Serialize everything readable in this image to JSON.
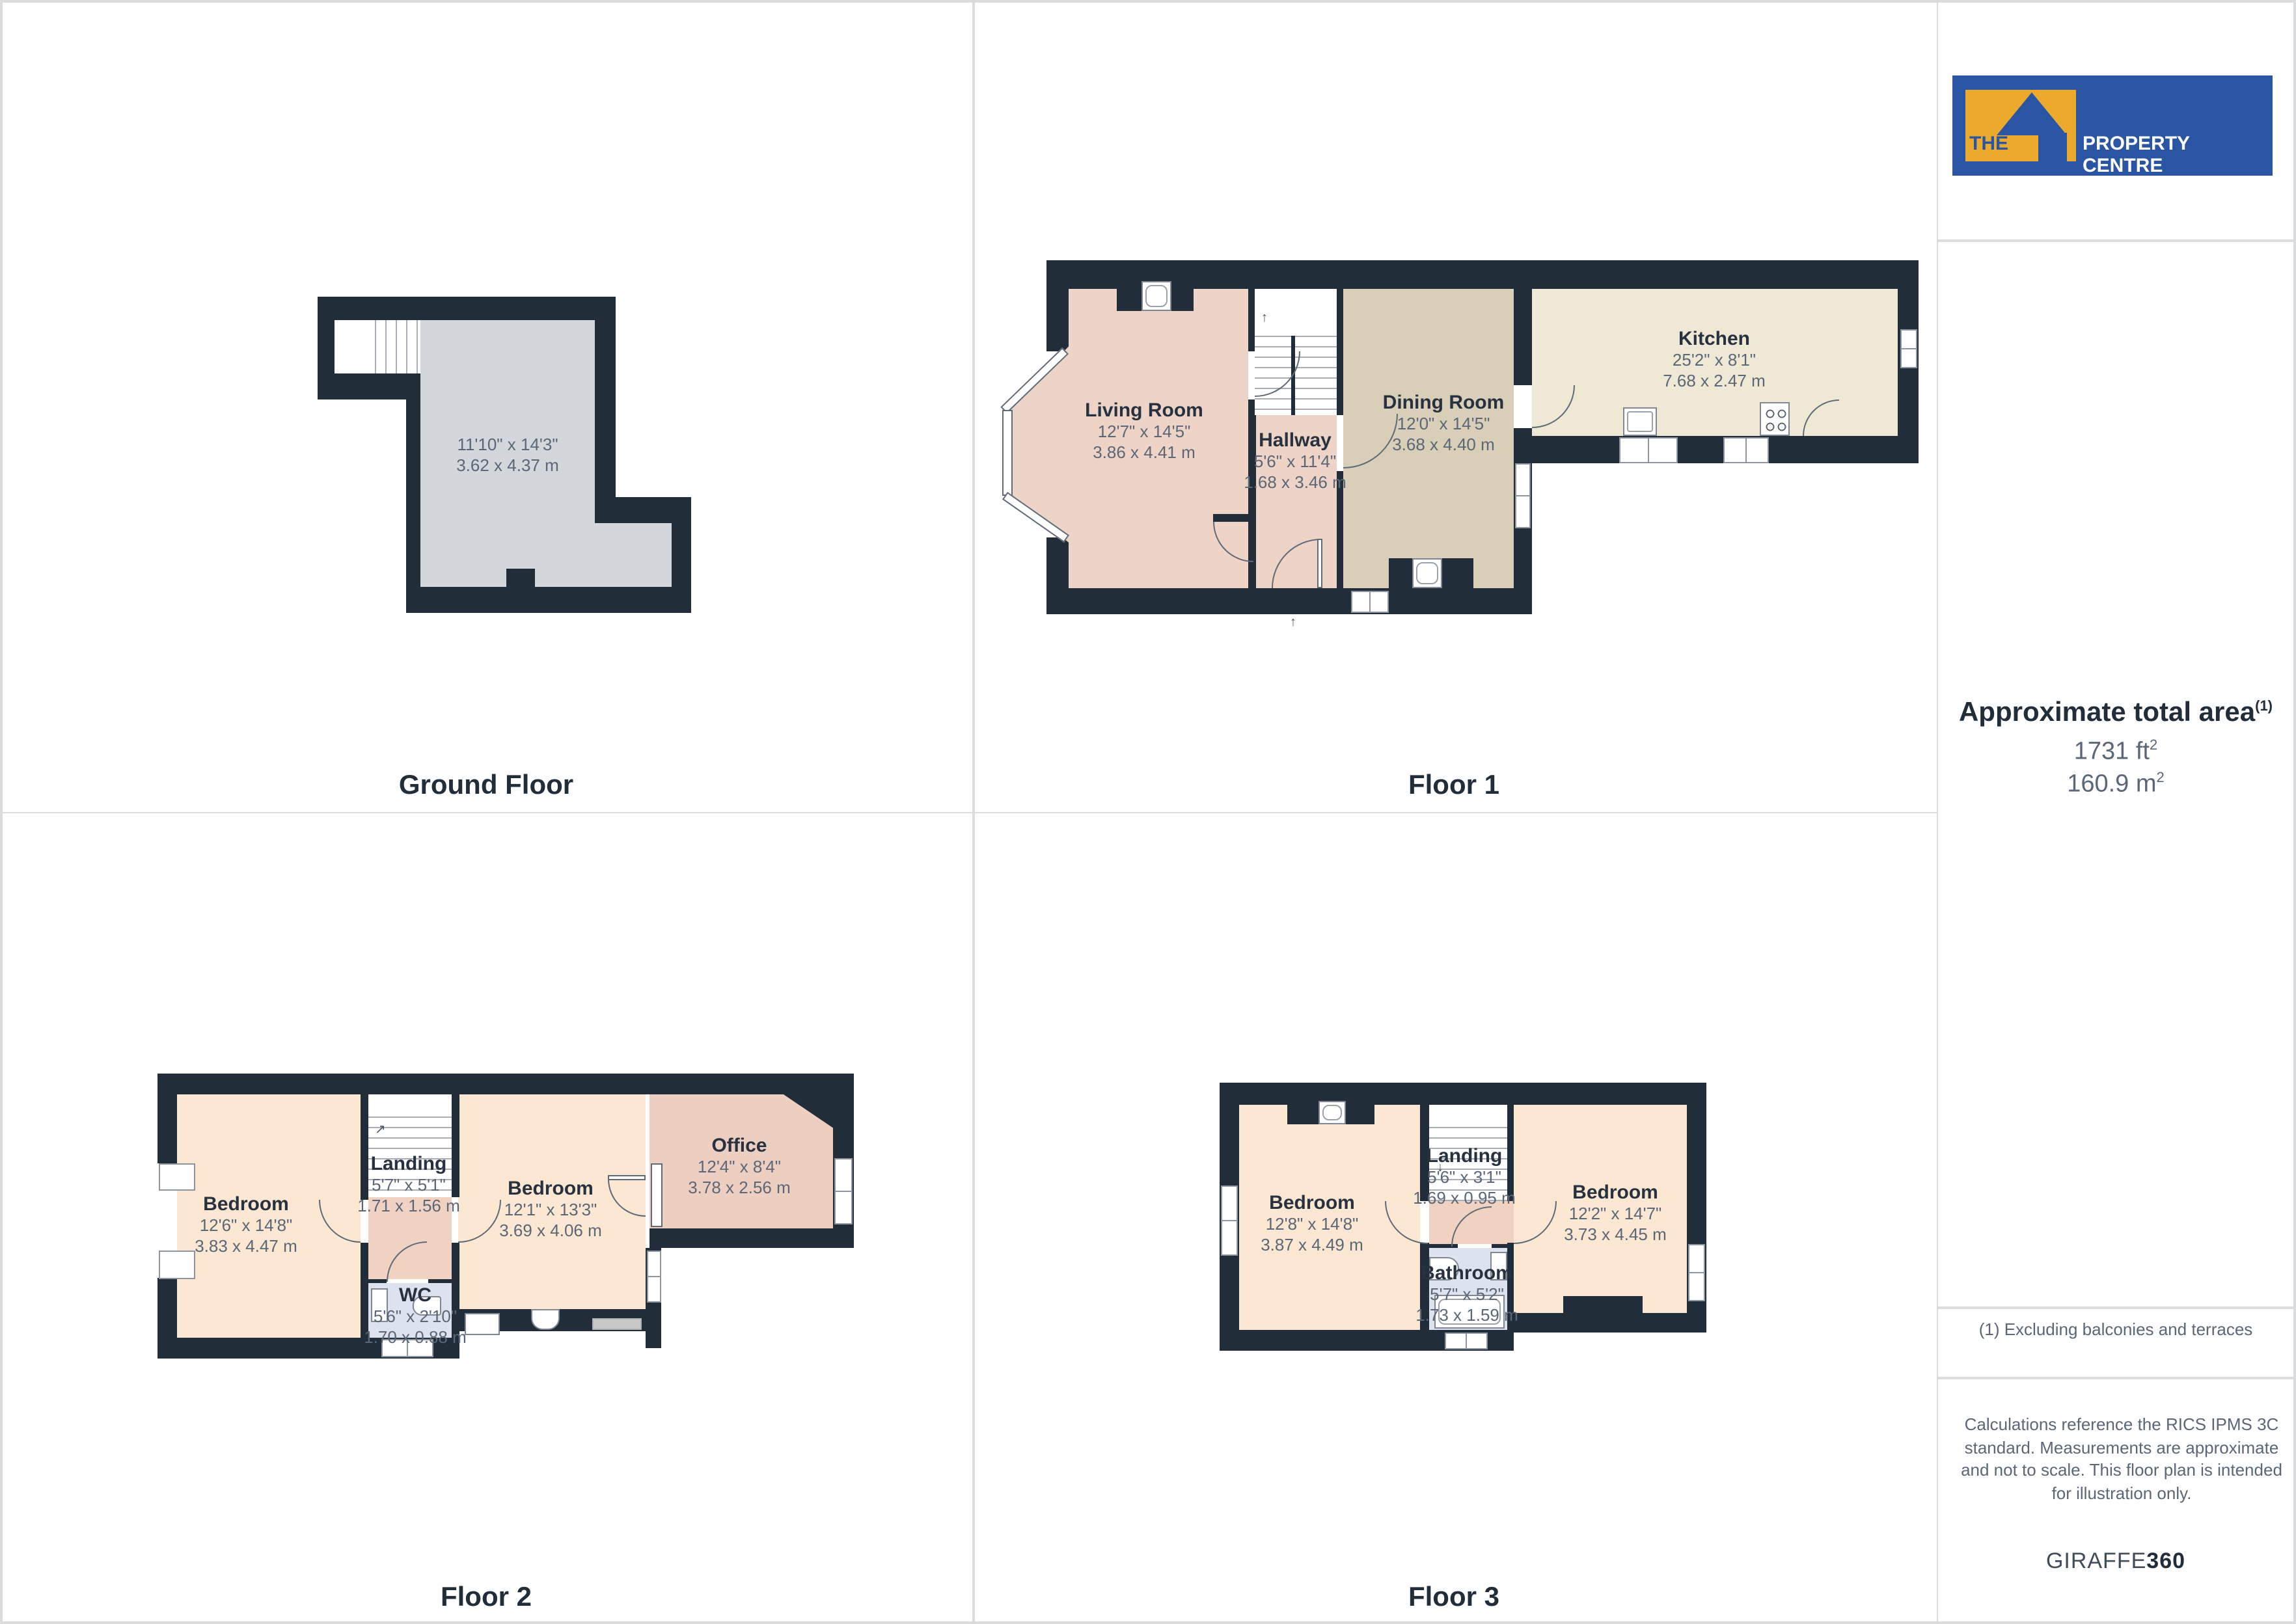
{
  "page": {
    "type": "floorplan-sheet",
    "colors": {
      "wall": "#222d3a",
      "living_pink": "#eed4c6",
      "bedroom_peach": "#fbe7d2",
      "dining_tan": "#d9ceb7",
      "kitchen_cream": "#efe8d5",
      "ground_gray": "#d3d6da",
      "landing_pink": "#f0d2c2",
      "bath_blue": "#dde3ee",
      "office_pink": "#eccfc1",
      "logo_blue": "#2a55a3",
      "logo_yellow": "#ecaa2d",
      "text_navy": "#27313f",
      "text_gray": "#5b6776"
    }
  },
  "floors": [
    {
      "label": "Ground Floor",
      "rooms": [
        {
          "name": "",
          "ft": "11'10\" x 14'3\"",
          "m": "3.62 x 4.37 m"
        }
      ]
    },
    {
      "label": "Floor 1",
      "rooms": [
        {
          "name": "Living Room",
          "ft": "12'7\" x 14'5\"",
          "m": "3.86 x 4.41 m"
        },
        {
          "name": "Hallway",
          "ft": "5'6\" x 11'4\"",
          "m": "1.68 x 3.46 m"
        },
        {
          "name": "Dining Room",
          "ft": "12'0\" x 14'5\"",
          "m": "3.68 x 4.40 m"
        },
        {
          "name": "Kitchen",
          "ft": "25'2\" x 8'1\"",
          "m": "7.68 x 2.47 m"
        }
      ]
    },
    {
      "label": "Floor 2",
      "rooms": [
        {
          "name": "Bedroom",
          "ft": "12'6\" x 14'8\"",
          "m": "3.83 x 4.47 m"
        },
        {
          "name": "Landing",
          "ft": "5'7\" x 5'1\"",
          "m": "1.71 x 1.56 m"
        },
        {
          "name": "WC",
          "ft": "5'6\" x 2'10\"",
          "m": "1.70 x 0.88 m"
        },
        {
          "name": "Bedroom",
          "ft": "12'1\" x 13'3\"",
          "m": "3.69 x 4.06 m"
        },
        {
          "name": "Office",
          "ft": "12'4\" x 8'4\"",
          "m": "3.78 x 2.56 m"
        }
      ]
    },
    {
      "label": "Floor 3",
      "rooms": [
        {
          "name": "Bedroom",
          "ft": "12'8\" x 14'8\"",
          "m": "3.87 x 4.49 m"
        },
        {
          "name": "Landing",
          "ft": "5'6\" x 3'1\"",
          "m": "1.69 x 0.95 m"
        },
        {
          "name": "Bathroom",
          "ft": "5'7\" x 5'2\"",
          "m": "1.73 x 1.59 m"
        },
        {
          "name": "Bedroom",
          "ft": "12'2\" x 14'7\"",
          "m": "3.73 x 4.45 m"
        }
      ]
    }
  ],
  "sidebar": {
    "logo_the": "THE",
    "logo_rest": "PROPERTY CENTRE",
    "area_title": "Approximate total area",
    "area_sup": "(1)",
    "area_ft": "1731 ft",
    "area_m": "160.9 m",
    "sup2": "2",
    "footnote": "(1) Excluding balconies and terraces",
    "disclaimer": "Calculations reference the RICS IPMS 3C standard. Measurements are approximate and not to scale. This floor plan is intended for illustration only.",
    "brand": "GIRAFFE",
    "brand_num": "360"
  }
}
